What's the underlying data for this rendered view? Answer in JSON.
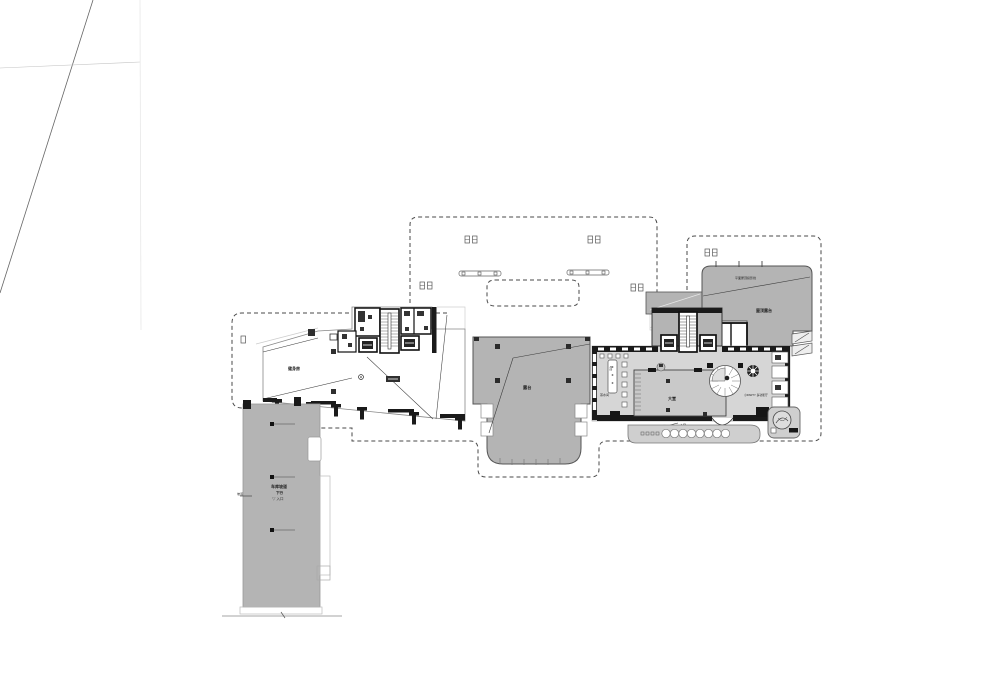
{
  "document": {
    "type": "architectural floor plan (CAD site / ground floor drawing)",
    "background": "#ffffff"
  },
  "colors": {
    "wall": "#1a1a1a",
    "line": "#777777",
    "faint_line": "#cccccc",
    "dashed_boundary": "#4a4a4a",
    "gray_dark": "#b4b4b4",
    "gray_mid": "#c9c9c9",
    "gray_light": "#d6d6d6",
    "gray_band": "#cfcfcf",
    "text": "#1f1f1f"
  },
  "labels": {
    "left_room": "健身房",
    "terrace": "露台",
    "lobby": "大堂",
    "pantry": "茶水间",
    "bar": "吧台",
    "party": "小PARTY 多功能厅",
    "roof_projection": "平面屋顶投影线",
    "roof_terrace": "屋顶露台",
    "machine": "机房",
    "entry_mark": "✳",
    "entry_text": "入口",
    "tree": "树池",
    "ramp_title": "车库坡道",
    "ramp_sub": "下行",
    "ramp_entry": "▽ 入口",
    "ramp_flag": "坡道"
  }
}
